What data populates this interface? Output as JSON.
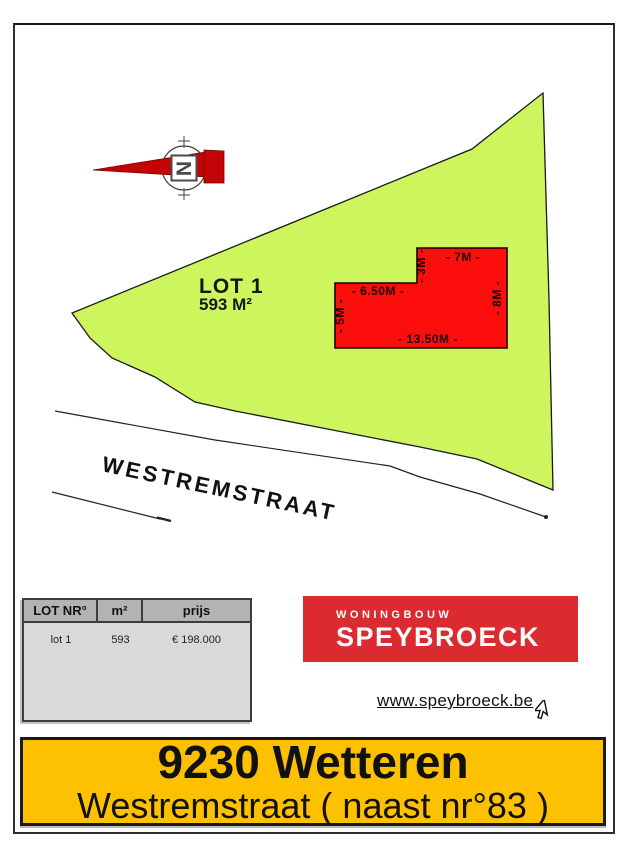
{
  "plan": {
    "compass": {
      "letter": "N"
    },
    "lot": {
      "label": "LOT 1",
      "area": "593 M²"
    },
    "street": "WESTREMSTRAAT",
    "building_dimensions": {
      "top_width": "- 7M -",
      "notch_height": "- 3M -",
      "upper_width": "- 6.50M -",
      "left_height": "- 5M -",
      "bottom_width": "- 13.50M -",
      "right_height": "- 8M -"
    },
    "colors": {
      "lot_fill": "#ccf55e",
      "building_fill": "#fb0e0c",
      "arrow_red": "#c40404"
    }
  },
  "price_table": {
    "headers": [
      "LOT NR°",
      "m²",
      "prijs"
    ],
    "rows": [
      [
        "lot 1",
        "593",
        "€ 198.000"
      ]
    ]
  },
  "logo": {
    "tagline": "WONINGBOUW",
    "name": "SPEYBROECK",
    "bg_color": "#dc2b30"
  },
  "website": {
    "url_text": "www.speybroeck.be"
  },
  "address_banner": {
    "city": "9230 Wetteren",
    "street": "Westremstraat ( naast nr°83 )",
    "bg_color": "#fdc101"
  }
}
